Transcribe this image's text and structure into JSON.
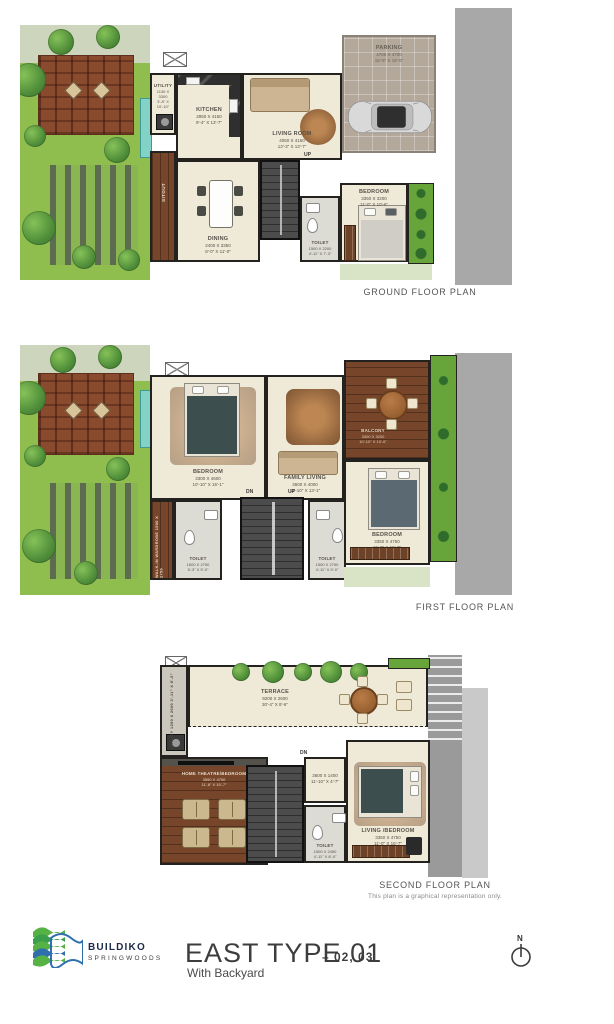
{
  "ground": {
    "caption": "GROUND FLOOR PLAN",
    "up": "UP",
    "rooms": {
      "utility": {
        "label": "UTILITY",
        "mm": "1130 X 3300",
        "ft": "3'-8\" X 10'-10\""
      },
      "kitchen": {
        "label": "KITCHEN",
        "mm": "2850 X 4150",
        "ft": "9'-4\" X 13'-7\""
      },
      "living": {
        "label": "LIVING ROOM",
        "mm": "4050 X 4150",
        "ft": "13'-3\" X 13'-7\""
      },
      "dining": {
        "label": "DINING",
        "mm": "2400 X 3350",
        "ft": "8'-0\" X 11'-0\""
      },
      "sitout": {
        "label": "SITOUT"
      },
      "toilet": {
        "label": "TOILET",
        "mm": "1500 X 2200",
        "ft": "4'-11\" X 7'-3\""
      },
      "bedroom": {
        "label": "BEDROOM",
        "mm": "3350 X 3200",
        "ft": "11'-0\" X 10'-6\""
      },
      "parking": {
        "label": "PARKING",
        "mm": "4700 X 4700",
        "ft": "15'-5\" X 15'-5\""
      }
    }
  },
  "first": {
    "caption": "FIRST FLOOR PLAN",
    "up": "UP",
    "dn": "DN",
    "rooms": {
      "bedroom1": {
        "label": "BEDROOM",
        "mm": "3300 X 4600",
        "ft": "10'-10\" X 15'-1\""
      },
      "family": {
        "label": "FAMILY LIVING",
        "mm": "3600 X 4000",
        "ft": "11'-10\" X 13'-1\""
      },
      "balcony": {
        "label": "BALCONY",
        "mm": "3300 X 3200",
        "ft": "10'-10\" X 10'-6\""
      },
      "bedroom2": {
        "label": "BEDROOM",
        "mm": "3350 X 4750",
        "ft": "11'-0\" X 15'-7\""
      },
      "toilet1": {
        "label": "TOILET",
        "mm": "1600 X 2750",
        "ft": "5'-3\" X 9'-0\""
      },
      "toilet2": {
        "label": "TOILET",
        "mm": "1500 X 2750",
        "ft": "4'-11\" X 9'-0\""
      },
      "wardrobe": {
        "label": "WALK-IN WARDROBE",
        "mm": "1500 X 2750"
      }
    }
  },
  "second": {
    "caption": "SECOND FLOOR PLAN",
    "disclaimer": "This plan is a graphical representation only.",
    "dn": "DN",
    "rooms": {
      "utility": {
        "label": "UTILITY",
        "mm": "1200 X 2600",
        "ft": "3'-11\" X 8'-6\""
      },
      "terrace": {
        "label": "TERRACE",
        "mm": "9200 X 2600",
        "ft": "30'-4\" X 8'-6\""
      },
      "hometheatre": {
        "label": "HOME THEATRE/BEDROOM",
        "mm": "3550 X 4750",
        "ft": "11'-8\" X 15'-7\""
      },
      "passage": {
        "mm": "3600 X 1400",
        "ft": "11'-10\" X 4'-7\""
      },
      "livingbedroom": {
        "label": "LIVING /BEDROOM",
        "mm": "3350 X 4750",
        "ft": "11'-0\" X 15'-7\""
      },
      "toilet": {
        "label": "TOILET",
        "mm": "1500 X 2450",
        "ft": "4'-11\" X 8'-0\""
      }
    }
  },
  "footer": {
    "brand": "BUILDIKO",
    "brand_sub": "SPRINGWOODS",
    "title": "EAST TYPE 01",
    "title_suffix": "– 02, 03",
    "subtitle": "With Backyard",
    "north_label": "N"
  },
  "colors": {
    "wall": "#23221f",
    "floor": "#efe9d8",
    "garden_green": "#8fbe4f",
    "deck_brown": "#8a4a2e",
    "parking_gray": "#b3a89a",
    "neighbor_gray": "#a8a8a8",
    "logo_green": "#56b244",
    "logo_blue": "#2f6fae",
    "brand_navy": "#1c2b4a"
  }
}
